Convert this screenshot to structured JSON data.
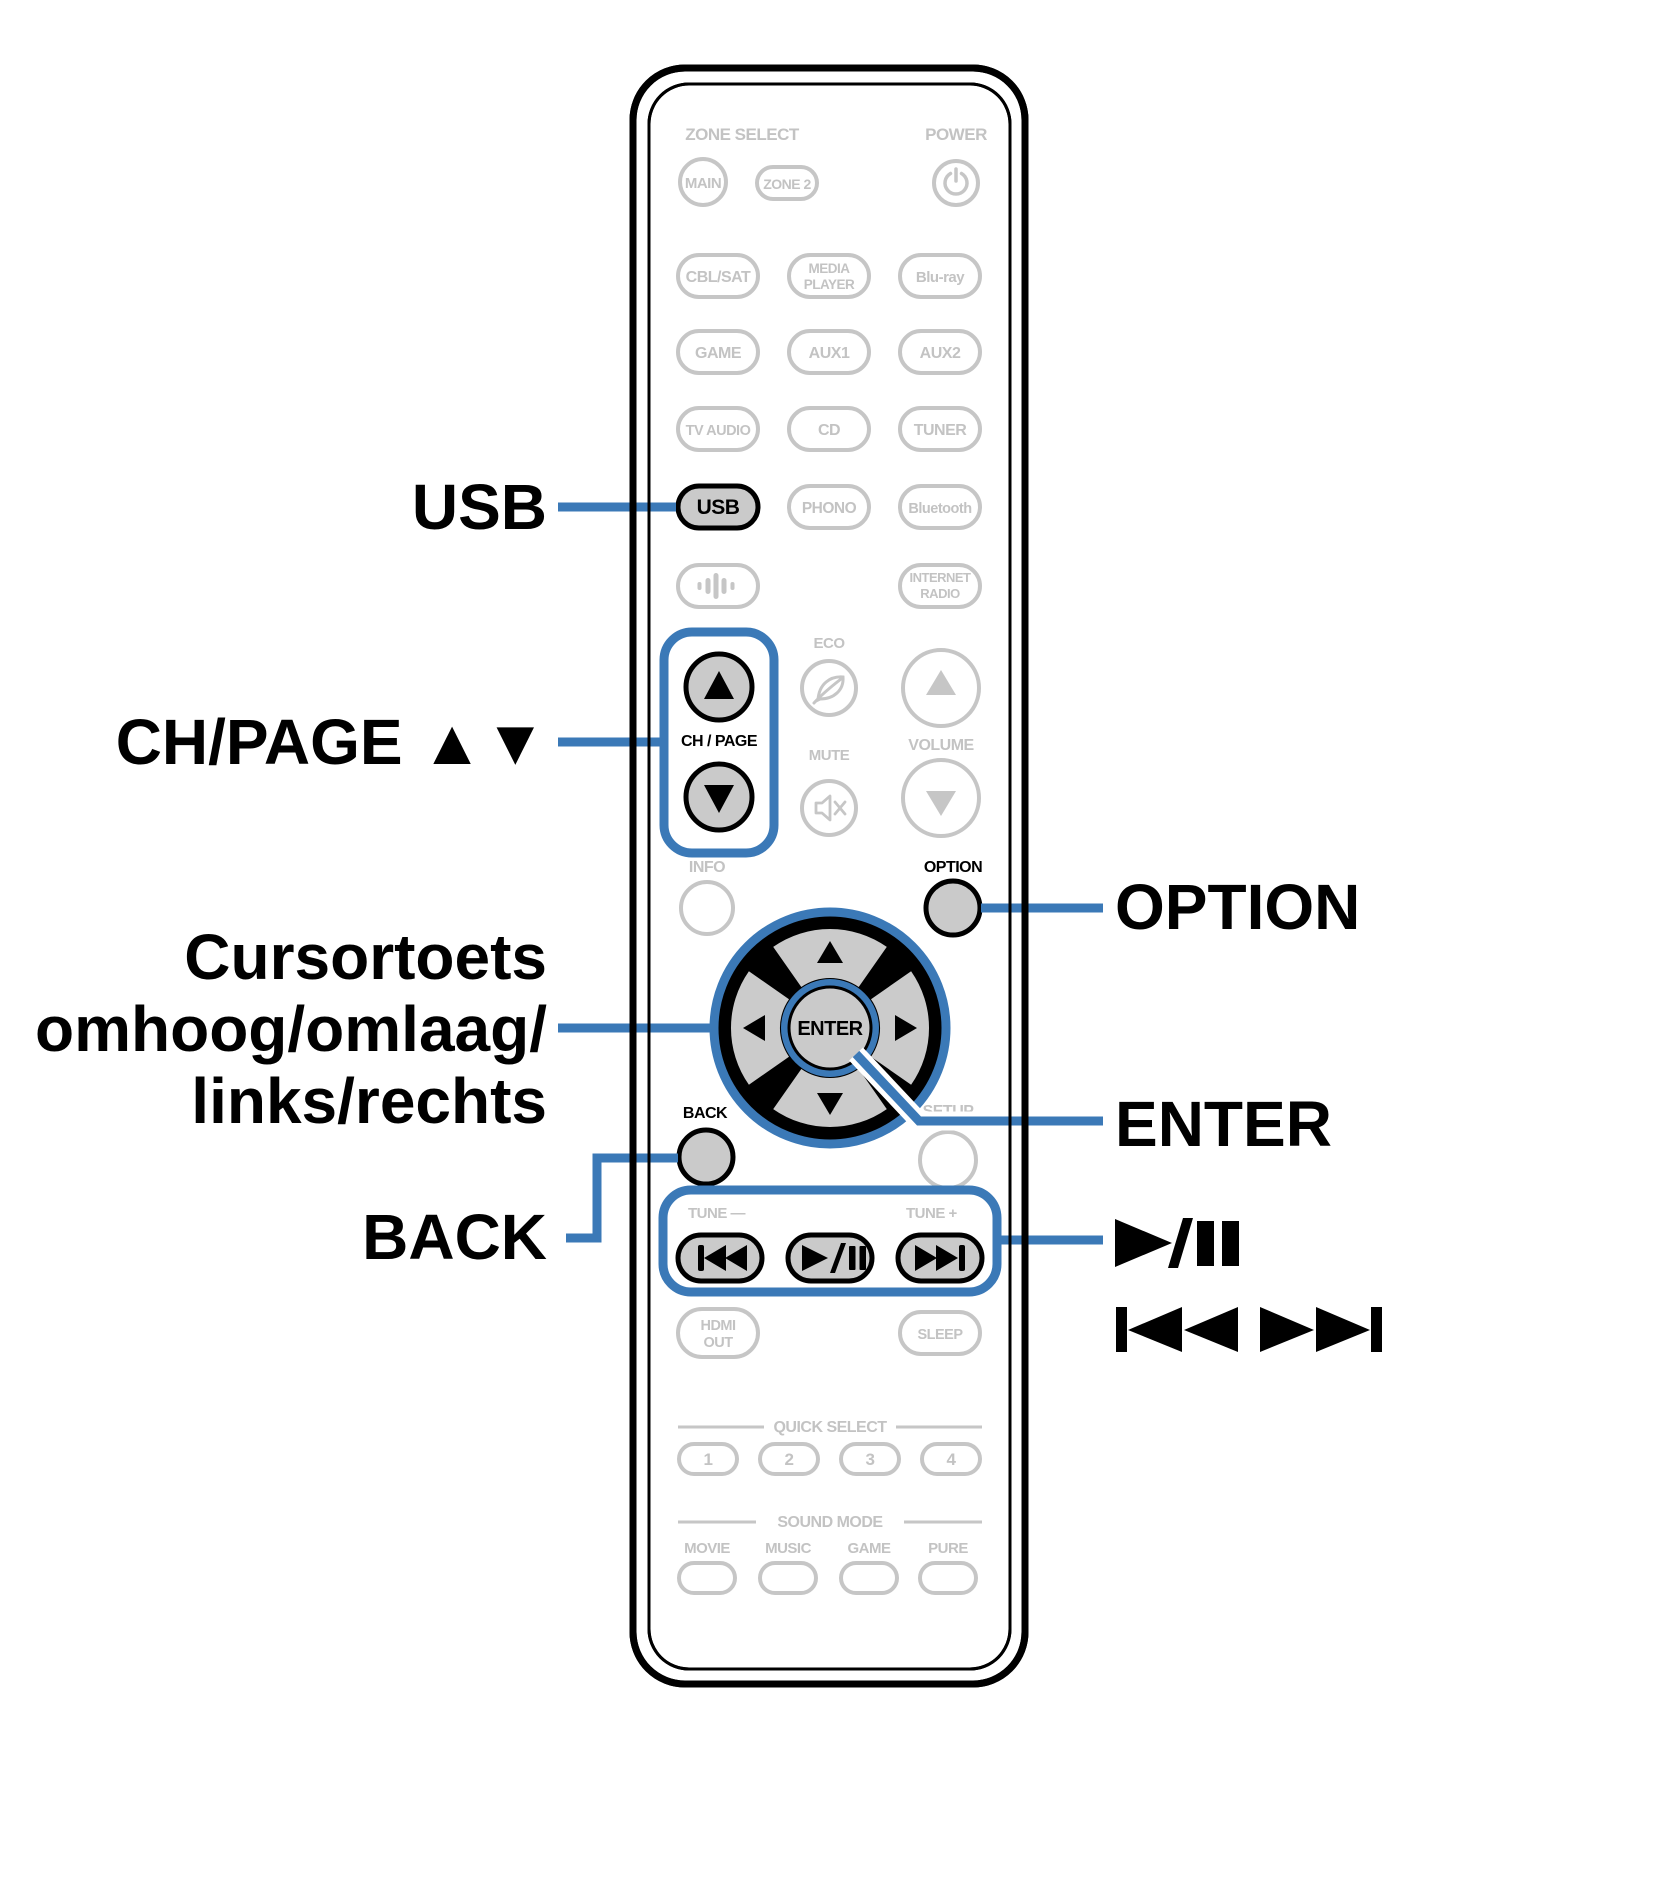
{
  "colors": {
    "accent_blue": "#3b79b7",
    "outline_gray": "#c6c6c6",
    "label_gray": "#c3c3c3",
    "highlight_fill": "#cacaca",
    "black": "#000000"
  },
  "remote": {
    "zone_select_label": "ZONE SELECT",
    "power_label": "POWER",
    "buttons": {
      "main": "MAIN",
      "zone2": "ZONE 2",
      "cbl_sat": "CBL/SAT",
      "media_player": [
        "MEDIA",
        "PLAYER"
      ],
      "bluray": "Blu-ray",
      "game": "GAME",
      "aux1": "AUX1",
      "aux2": "AUX2",
      "tv_audio": "TV AUDIO",
      "cd": "CD",
      "tuner": "TUNER",
      "usb": "USB",
      "phono": "PHONO",
      "bluetooth": "Bluetooth",
      "internet_radio": [
        "INTERNET",
        "RADIO"
      ]
    },
    "eco_label": "ECO",
    "ch_page_label": "CH / PAGE",
    "mute_label": "MUTE",
    "volume_label": "VOLUME",
    "info_label": "INFO",
    "option_label": "OPTION",
    "enter_label": "ENTER",
    "back_label": "BACK",
    "setup_label": "SETUP",
    "tune_minus_label": "TUNE —",
    "tune_plus_label": "TUNE +",
    "hdmi_out": [
      "HDMI",
      "OUT"
    ],
    "sleep_label": "SLEEP",
    "quick_select_label": "QUICK SELECT",
    "quick_select": [
      "1",
      "2",
      "3",
      "4"
    ],
    "sound_mode_label": "SOUND MODE",
    "sound_modes": [
      "MOVIE",
      "MUSIC",
      "GAME",
      "PURE"
    ]
  },
  "icons": {
    "power": "power-icon",
    "waveform": "waveform-icon",
    "eco_leaf": "leaf-icon",
    "mute": "mute-speaker-icon",
    "cursor_arrows": "up/down/left/right triangles",
    "skip_back": "skip-back-icon",
    "play_pause": "play-pause-icon",
    "skip_forward": "skip-forward-icon"
  },
  "callouts": {
    "usb": "USB",
    "ch_page": "CH/PAGE ▲▼",
    "cursor": [
      "Cursortoets",
      "omhoog/omlaag/",
      "links/rechts"
    ],
    "back": "BACK",
    "option": "OPTION",
    "enter": "ENTER"
  }
}
